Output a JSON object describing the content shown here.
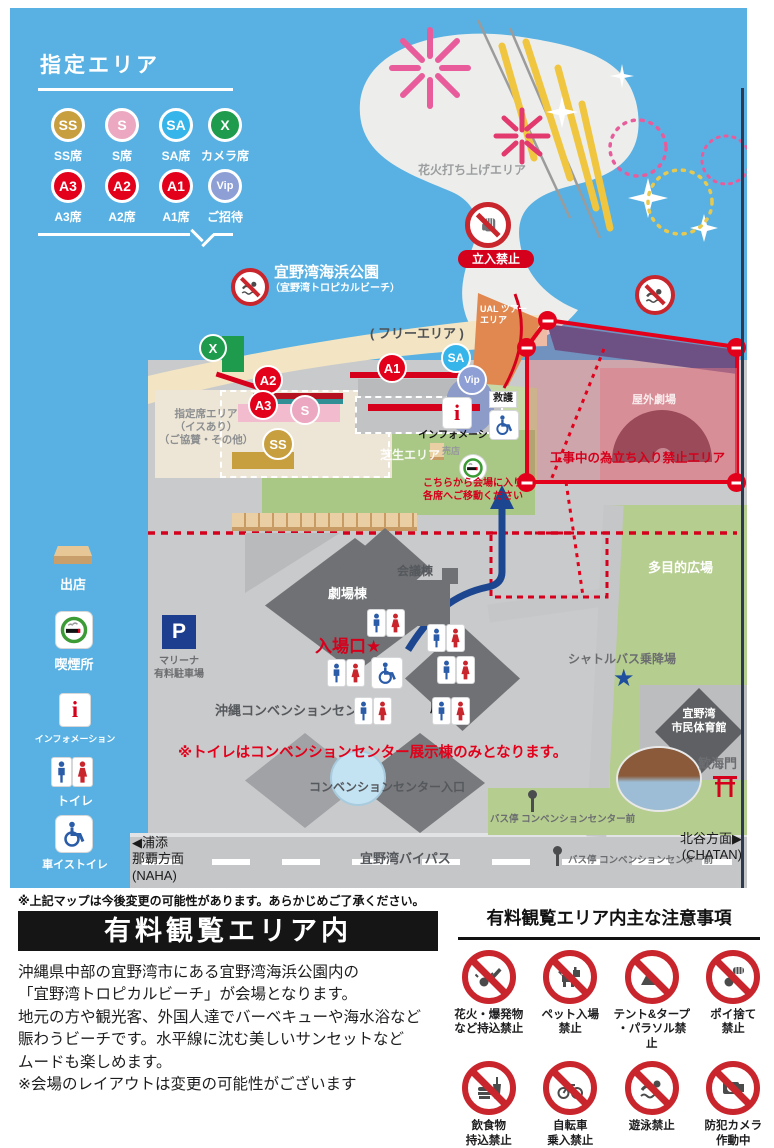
{
  "colors": {
    "ocean": "#58B1E2",
    "land": "#C9CACB",
    "sand": "#F3E5C3",
    "lawn": "#A9C785",
    "field": "#B5CD8E",
    "orange": "#E08850",
    "red": "#E3001B",
    "navy": "#1D4690",
    "building": "#6F7174",
    "gold": "#C79F3F",
    "pink": "#F2BCCE",
    "teal": "#2F8F95",
    "lavender": "#8E9FD5"
  },
  "legend": {
    "title": "指定エリア",
    "items": [
      {
        "code": "SS",
        "label": "SS席",
        "color": "#C79F3F"
      },
      {
        "code": "S",
        "label": "S席",
        "color": "#EBA8C0"
      },
      {
        "code": "SA",
        "label": "SA席",
        "color": "#35B5E9"
      },
      {
        "code": "X",
        "label": "カメラ席",
        "color": "#1E9B4C"
      },
      {
        "code": "A3",
        "label": "A3席",
        "color": "#E3001B"
      },
      {
        "code": "A2",
        "label": "A2席",
        "color": "#E3001B"
      },
      {
        "code": "A1",
        "label": "A1席",
        "color": "#E3001B"
      },
      {
        "code": "Vip",
        "label": "ご招待",
        "color": "#8E9FD5"
      }
    ]
  },
  "sidebar": {
    "items": [
      {
        "label": "出店"
      },
      {
        "label": "喫煙所"
      },
      {
        "label": "インフォメーション"
      },
      {
        "label": "トイレ"
      },
      {
        "label": "車イストイレ"
      }
    ]
  },
  "map": {
    "labels": {
      "fireworks_area": "花火打ち上げエリア",
      "no_entry": "立入禁止",
      "park": "宜野湾海浜公園",
      "park_sub": "（宜野湾トロピカルビーチ）",
      "free_area": "( フリーエリア )",
      "tour_area": "UAL ツアー\nエリア",
      "reserved": "指定席エリア\n（イスあり）\n（ご協賛・その他）",
      "info": "インフォメーション",
      "info_i": "i",
      "first_aid": "救護",
      "lawn": "芝生エリア",
      "shop": "売店",
      "theater_out": "屋外劇場",
      "construction": "工事中の為立ち入り禁止エリア",
      "enter_here": "こちらから会場に入り\n各席へご移動ください",
      "theater": "劇場棟",
      "conference": "会議棟",
      "entrance": "入場口★",
      "center": "沖縄コンベンションセンター",
      "exhibition": "展示棟",
      "parking_p": "P",
      "parking": "マリーナ\n有料駐車場",
      "multipurpose": "多目的広場",
      "shuttle": "シャトルバス乗降場",
      "star": "★",
      "gym": "宜野湾\n市民体育館",
      "toilet_note": "※トイレはコンベンションセンター展示棟のみとなります。",
      "cc_entrance": "コンベンションセンター入口",
      "kankaimon": "歓海門",
      "bus_stop": "バス停 コンベンションセンター前",
      "naha": "◀浦添\n那覇方面\n(NAHA)",
      "bypass": "宜野湾バイパス",
      "chatan": "北谷方面▶\n(CHATAN)"
    }
  },
  "footnote": "※上記マップは今後変更の可能性があります。あらかじめご了承ください。",
  "info": {
    "banner": "有料観覧エリア内",
    "paragraph": "沖縄県中部の宜野湾市にある宜野湾海浜公園内の\n「宜野湾トロピカルビーチ」が会場となります。\n地元の方や観光客、外国人達でバーベキューや海水浴など\n賑わうビーチです。水平線に沈む美しいサンセットなど\nムードも楽しめます。\n※会場のレイアウトは変更の可能性がございます"
  },
  "rules": {
    "title": "有料観覧エリア内主な注意事項",
    "items": [
      {
        "label": "花火・爆発物\nなど持込禁止"
      },
      {
        "label": "ペット入場\n禁止"
      },
      {
        "label": "テント&タープ\n・パラソル禁止"
      },
      {
        "label": "ポイ捨て\n禁止"
      },
      {
        "label": "飲食物\n持込禁止"
      },
      {
        "label": "自転車\n乗入禁止"
      },
      {
        "label": "遊泳禁止"
      },
      {
        "label": "防犯カメラ\n作動中"
      }
    ]
  }
}
